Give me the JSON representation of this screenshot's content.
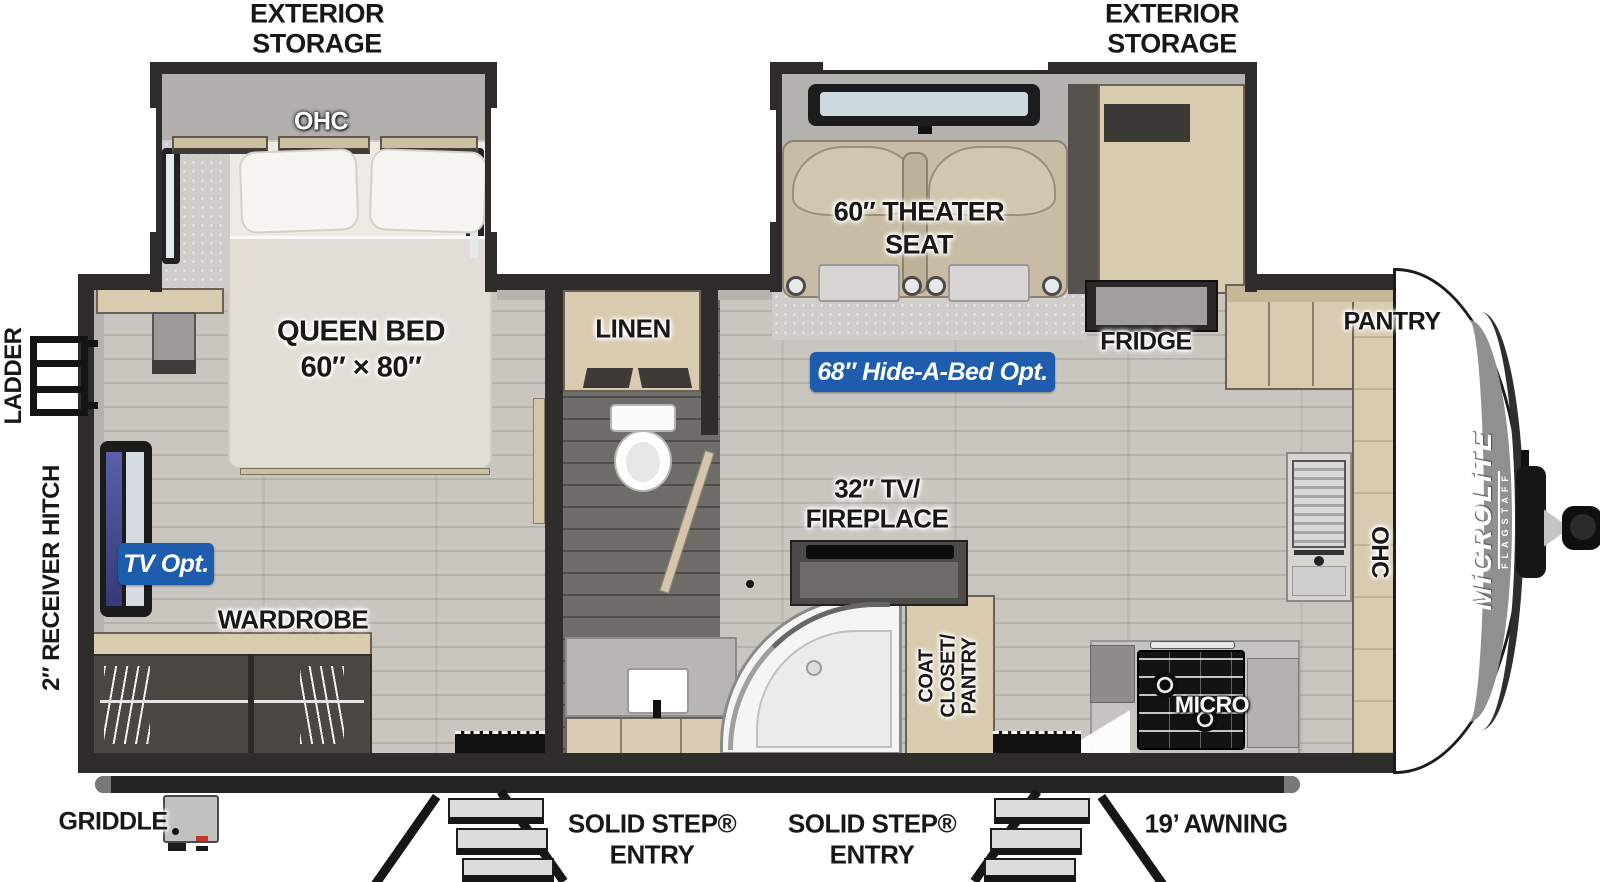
{
  "colors": {
    "badge_blue": "#1e5cae",
    "wall_dark": "#2e2d2b",
    "cabinet_tan": "#d8cbb0",
    "floor_light": "#c9c6c0",
    "floor_dark": "#6e6c69",
    "brand_gray": "#909090"
  },
  "exterior": {
    "storage_left_1": "EXTERIOR",
    "storage_left_2": "STORAGE",
    "storage_right_1": "EXTERIOR",
    "storage_right_2": "STORAGE",
    "ladder": "LADDER",
    "receiver_hitch": "2″ RECEIVER HITCH",
    "griddle": "GRIDDLE",
    "entry_a_1": "SOLID STEP®",
    "entry_a_2": "ENTRY",
    "entry_b_1": "SOLID STEP®",
    "entry_b_2": "ENTRY",
    "awning": "19’ AWNING",
    "brand": "MiCROLiTE",
    "brand_sub": "FLAGSTAFF"
  },
  "bedroom": {
    "ohc": "OHC",
    "bed_1": "QUEEN BED",
    "bed_2": "60″ × 80″",
    "wardrobe": "WARDROBE",
    "tv_badge": "TV Opt."
  },
  "bath": {
    "linen": "LINEN"
  },
  "living": {
    "theater_1": "60″ THEATER",
    "theater_2": "SEAT",
    "hide_a_bed": "68″ Hide-A-Bed Opt.",
    "tv_fireplace_1": "32″ TV/",
    "tv_fireplace_2": "FIREPLACE",
    "coat_1": "COAT",
    "coat_2": "CLOSET/",
    "coat_3": "PANTRY"
  },
  "kitchen": {
    "fridge": "FRIDGE",
    "pantry": "PANTRY",
    "ohc": "OHC",
    "micro": "MICRO"
  }
}
